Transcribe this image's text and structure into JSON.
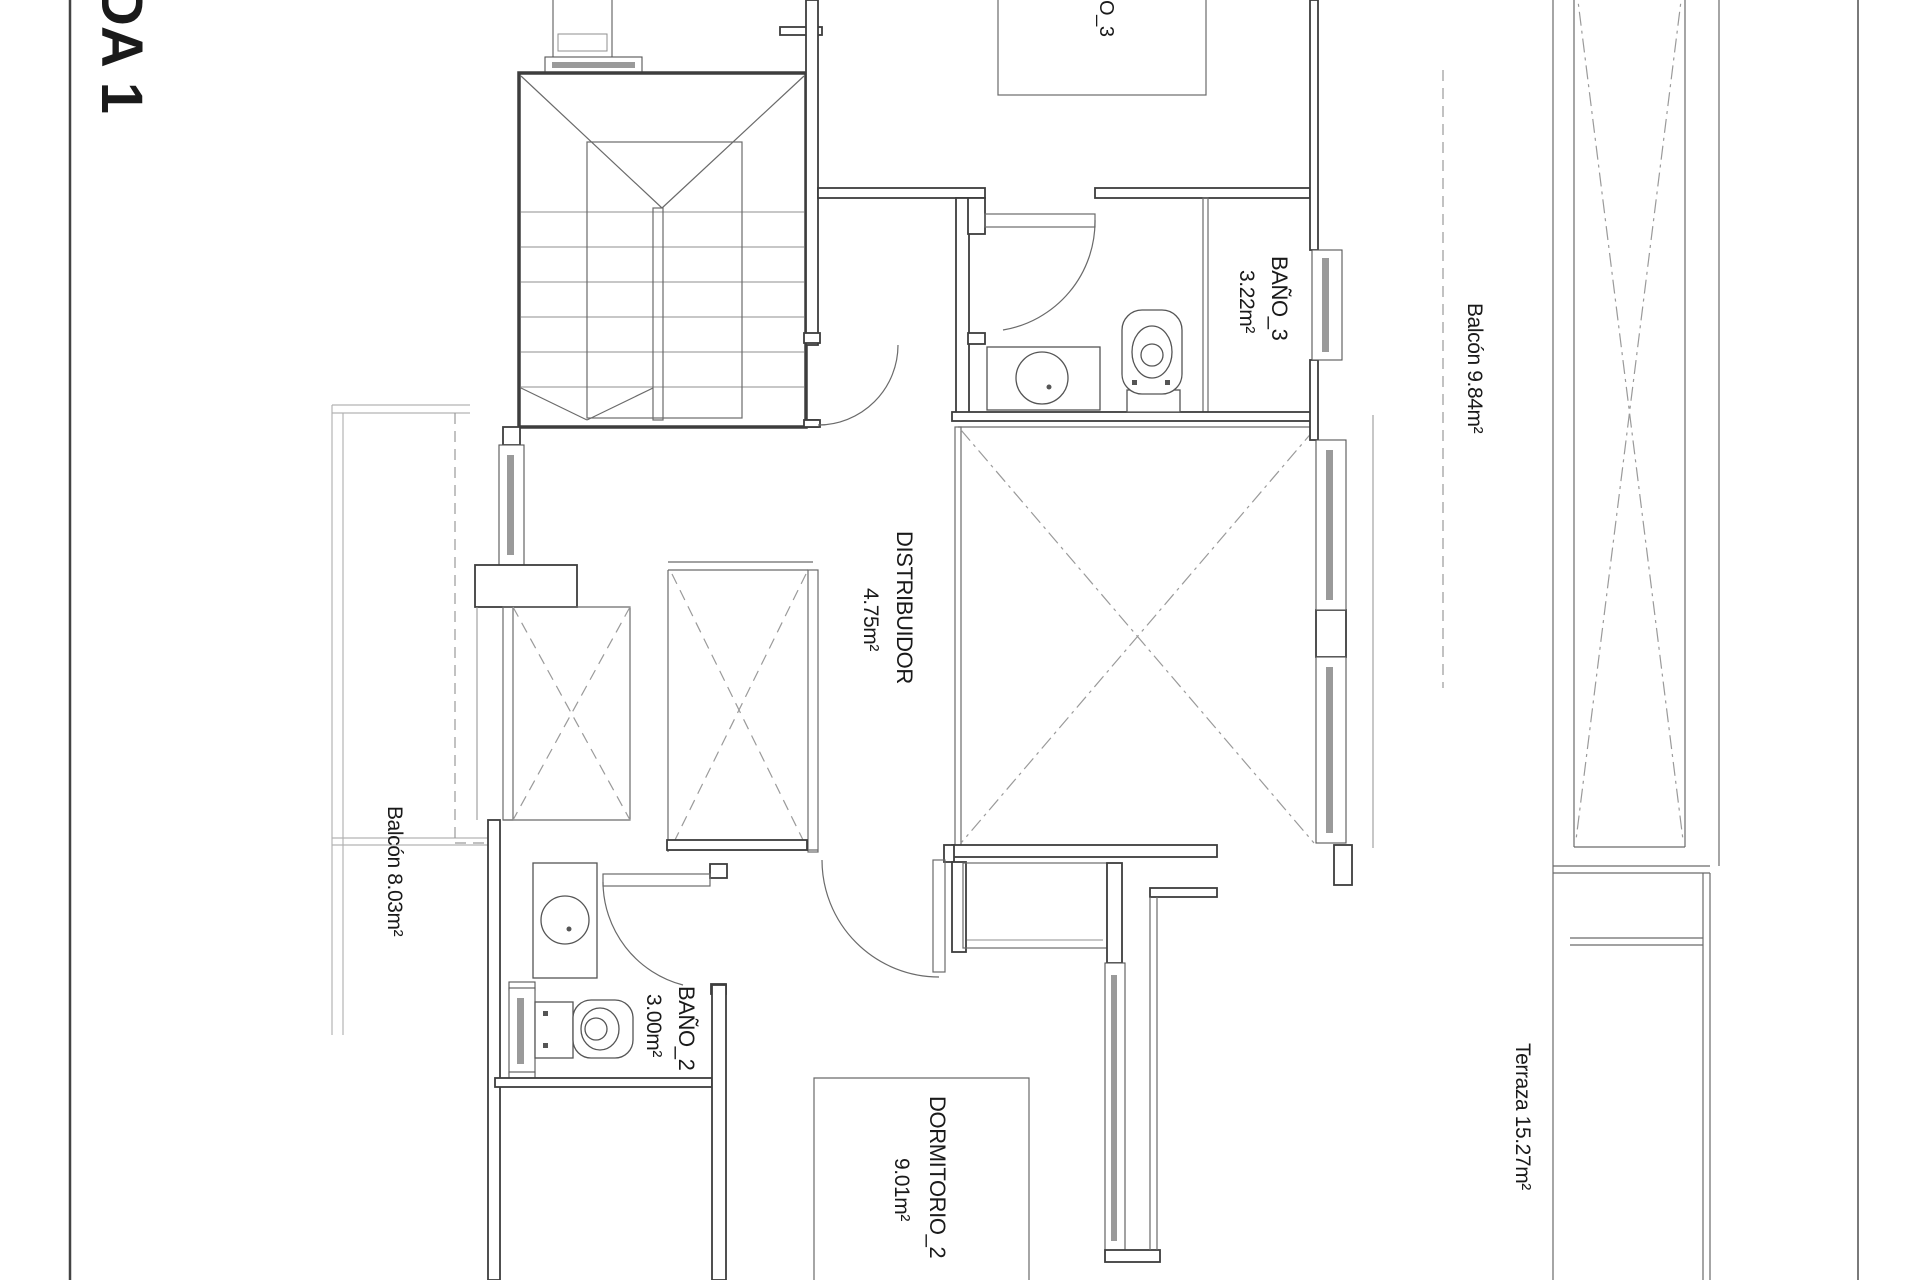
{
  "drawing": {
    "sheet_title_partial": "DA 1",
    "labels": {
      "dormitorio3_partial": "O_3",
      "bano3_name": "BAÑO_3",
      "bano3_area": "3.22m²",
      "balcon_right": "Balcón 9.84m²",
      "distribuidor_name": "DISTRIBUIDOR",
      "distribuidor_area": "4.75m²",
      "balcon_left": "Balcón 8.03m²",
      "bano2_name": "BAÑO_2",
      "bano2_area": "3.00m²",
      "dormitorio2_name": "DORMITORIO_2",
      "dormitorio2_area": "9.01m²",
      "terraza": "Terraza 15.27m²"
    },
    "colors": {
      "background": "#ffffff",
      "wall": "#3d3d3d",
      "thin_line": "#6a6a6a",
      "light_line": "#b3b3b3",
      "dashed_line": "#9a9a9a",
      "window_glass": "#9a9a9a",
      "text": "#1a1a1a"
    }
  }
}
